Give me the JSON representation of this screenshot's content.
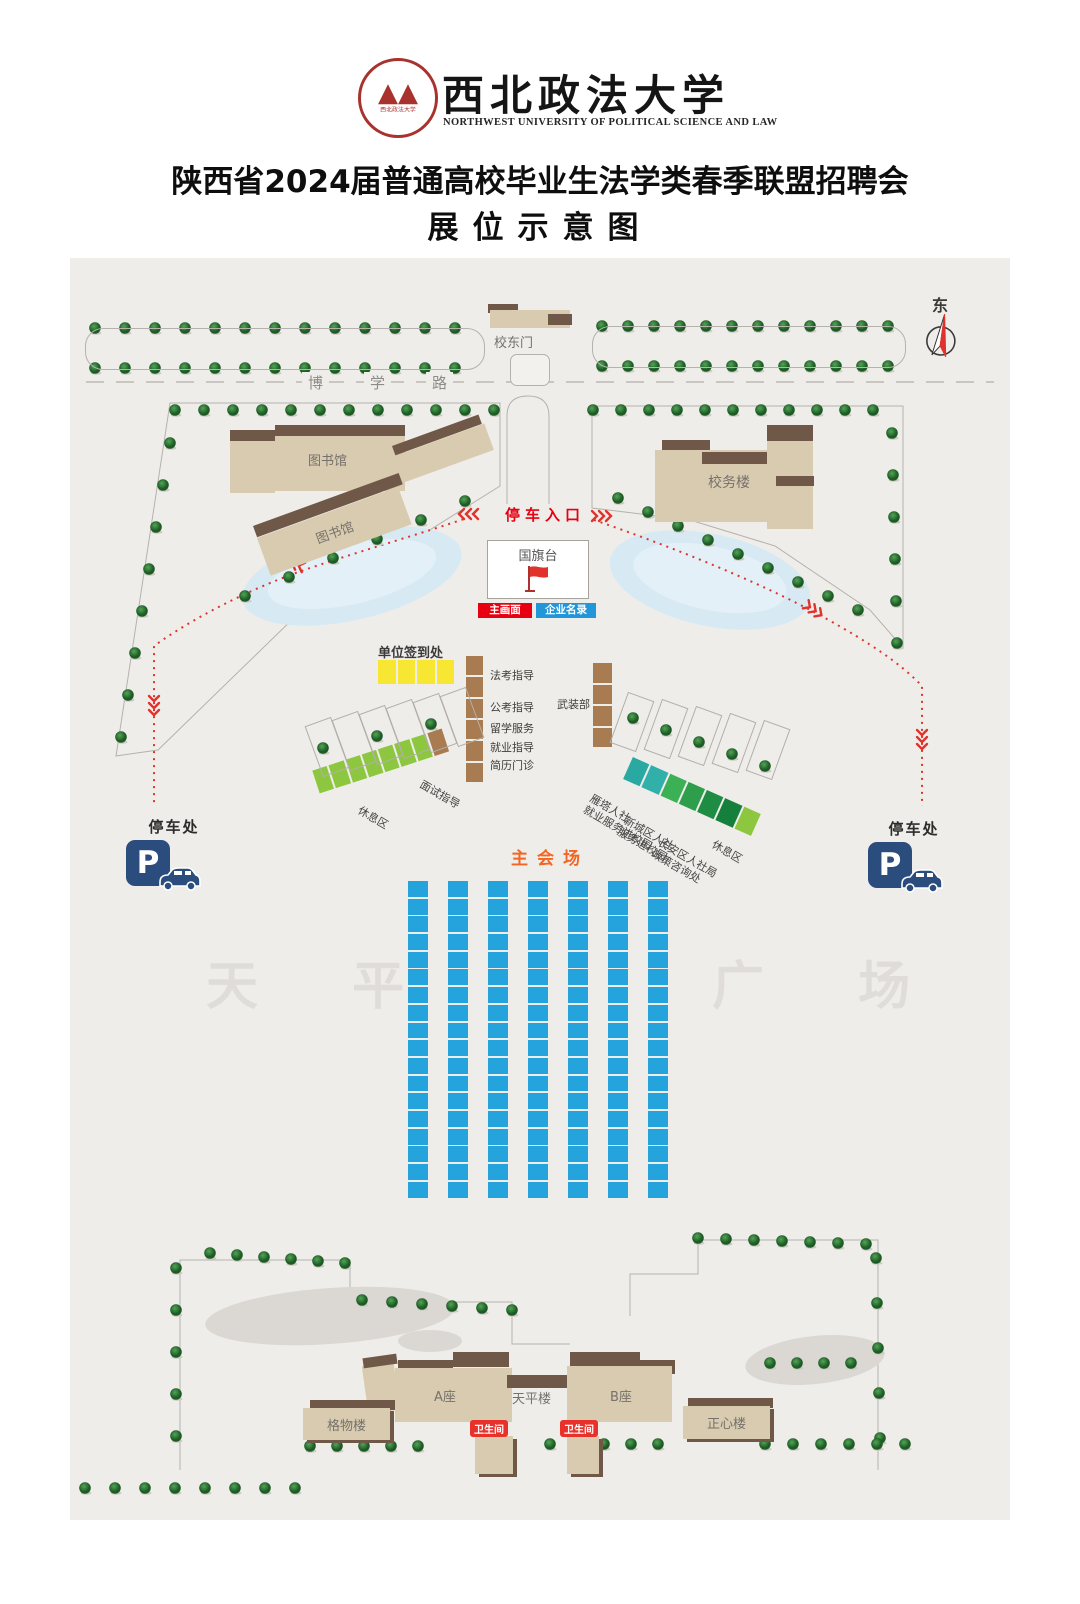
{
  "header": {
    "seal_glyph": "▲▲",
    "seal_text": "西北政法大学",
    "university_name_cn": "西北政法大学",
    "university_name_en": "NORTHWEST UNIVERSITY OF POLITICAL SCIENCE AND LAW",
    "title": "陕西省2024届普通高校毕业生法学类春季联盟招聘会",
    "subtitle": "展位示意图"
  },
  "map": {
    "compass_label": "东",
    "road_chars": [
      "博",
      "学",
      "路"
    ],
    "east_gate_label": "校东门",
    "library_label": "图书馆",
    "library_label_2": "图书馆",
    "admin_building_label": "校务楼",
    "parking_entrance_label": "停车入口",
    "flag_platform_label": "国旗台",
    "main_screen_label": "主画面",
    "company_directory_label": "企业名录",
    "checkin_label": "单位签到处",
    "service_booth_labels": [
      "法考指导",
      "公考指导",
      "留学服务",
      "就业指导",
      "简历门诊"
    ],
    "armed_forces_label": "武装部",
    "interview_guidance_label": "面试指导",
    "rest_area_left_label": "休息区",
    "right_strip_labels": [
      "雁塔人社\n就业服务进校园",
      "新城区人社\n服务进校园",
      "长安区人社局\n政策咨询处",
      "休息区"
    ],
    "parking_spot_label": "停车处",
    "parking_symbol": "P",
    "main_venue_label": "主会场",
    "square_watermark_left": "天 平",
    "square_watermark_right": "广 场",
    "block_a_label": "A座",
    "tianping_building_label": "天平楼",
    "block_b_label": "B座",
    "gewu_building_label": "格物楼",
    "zhengxin_building_label": "正心楼",
    "toilet_label": "卫生间",
    "booth_grid": {
      "columns": 7,
      "rows": 18,
      "cell_color": "#25a3dc"
    },
    "left_strip_cells": [
      "#8dc63f",
      "#8dc63f",
      "#8dc63f",
      "#8dc63f",
      "#8dc63f",
      "#8dc63f",
      "#8dc63f",
      "#a87c50"
    ],
    "right_strip_cells": [
      "#2aa9a2",
      "#31b0a9",
      "#3cb054",
      "#2f9e4c",
      "#1f8c44",
      "#15803c",
      "#8dc63f"
    ],
    "checkin_cells": 4,
    "service_column_cells": 6,
    "armed_column_cells": 4,
    "colors": {
      "booth_blue": "#25a3dc",
      "checkin_yellow": "#f7e733",
      "booth_brown": "#a87c50",
      "route_red": "#e0332c",
      "accent_red": "#e60012",
      "directory_blue": "#2196d9",
      "venue_orange": "#f26522"
    }
  }
}
